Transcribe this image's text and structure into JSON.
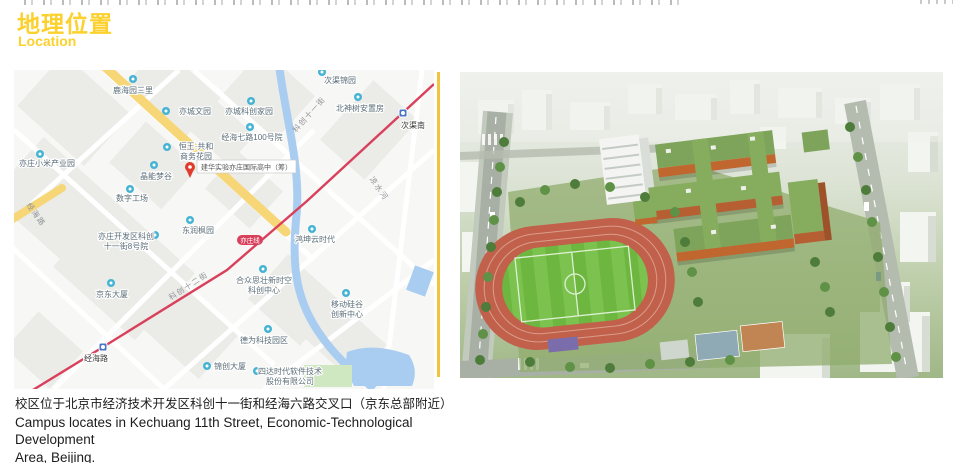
{
  "header": {
    "title_zh": "地理位置",
    "title_en": "Location",
    "accent_color": "#fcd12e"
  },
  "map": {
    "colors": {
      "poi": "#45b4d3",
      "metro_line": "#d8405b",
      "river": "#a9cdf1",
      "road_yellow": "#f6d677",
      "station": "#4a74c9",
      "pin": "#e03b2b"
    },
    "pin": {
      "x": 176,
      "y": 97,
      "label": "建华实验亦庄国际高中（筹）"
    },
    "line_badge": {
      "text": "亦庄线",
      "x": 236,
      "y": 171
    },
    "stations": [
      {
        "name": "次渠南",
        "icon": [
          389,
          43
        ],
        "label": [
          399,
          58
        ]
      },
      {
        "name": "经海路",
        "icon": [
          89,
          277
        ],
        "label": [
          82,
          291
        ]
      }
    ],
    "pois": [
      {
        "lines": [
          "鹿海园三里"
        ],
        "icon": [
          119,
          9
        ],
        "label": [
          119,
          23
        ]
      },
      {
        "lines": [
          "亦城文园"
        ],
        "icon": [
          152,
          41
        ],
        "label": [
          181,
          44
        ]
      },
      {
        "lines": [
          "亦城科创家园"
        ],
        "icon": [
          237,
          31
        ],
        "label": [
          235,
          44
        ]
      },
      {
        "lines": [
          "经海七路100号院"
        ],
        "icon": [
          236,
          57
        ],
        "label": [
          238,
          70
        ]
      },
      {
        "lines": [
          "恒王·共和",
          "商务花园"
        ],
        "icon": [
          153,
          77
        ],
        "label": [
          182,
          79
        ]
      },
      {
        "lines": [
          "晶能梦谷"
        ],
        "icon": [
          140,
          95
        ],
        "label": [
          142,
          109
        ]
      },
      {
        "lines": [
          "亦庄小米产业园"
        ],
        "icon": [
          26,
          84
        ],
        "label": [
          33,
          96
        ]
      },
      {
        "lines": [
          "数字工场"
        ],
        "icon": [
          116,
          119
        ],
        "label": [
          118,
          131
        ]
      },
      {
        "lines": [
          "亦庄开发区科创",
          "十一街8号院"
        ],
        "icon": [
          141,
          165
        ],
        "label": [
          112,
          169
        ]
      },
      {
        "lines": [
          "东润枫园"
        ],
        "icon": [
          176,
          150
        ],
        "label": [
          184,
          163
        ]
      },
      {
        "lines": [
          "鸿坤云时代"
        ],
        "icon": [
          298,
          159
        ],
        "label": [
          301,
          172
        ]
      },
      {
        "lines": [
          "京东大厦"
        ],
        "icon": [
          97,
          213
        ],
        "label": [
          98,
          227
        ]
      },
      {
        "lines": [
          "合众思壮新时空",
          "科创中心"
        ],
        "icon": [
          249,
          199
        ],
        "label": [
          250,
          213
        ]
      },
      {
        "lines": [
          "移动硅谷",
          "创新中心"
        ],
        "icon": [
          332,
          223
        ],
        "label": [
          333,
          237
        ]
      },
      {
        "lines": [
          "德为科技园区"
        ],
        "icon": [
          254,
          259
        ],
        "label": [
          250,
          273
        ]
      },
      {
        "lines": [
          "锦创大厦"
        ],
        "icon": [
          193,
          296
        ],
        "label": [
          216,
          299
        ]
      },
      {
        "lines": [
          "四达时代软件技术",
          "股份有限公司"
        ],
        "icon": [
          243,
          301
        ],
        "label": [
          276,
          304
        ]
      },
      {
        "lines": [
          "次渠锦园"
        ],
        "icon": [
          308,
          2
        ],
        "label": [
          326,
          13
        ]
      },
      {
        "lines": [
          "北神树安置房"
        ],
        "icon": [
          344,
          27
        ],
        "label": [
          346,
          41
        ]
      }
    ],
    "road_labels": [
      {
        "text": "科创十一街",
        "x": 297,
        "y": 46,
        "rot": -48
      },
      {
        "text": "科创十二街",
        "x": 176,
        "y": 218,
        "rot": -33
      },
      {
        "text": "经海路",
        "x": 20,
        "y": 146,
        "rot": 55
      },
      {
        "text": "凉水河",
        "x": 363,
        "y": 120,
        "rot": 55
      }
    ]
  },
  "caption": {
    "line1_zh": "校区位于北京市经济技术开发区科创十一街和经海六路交叉口（京东总部附近）",
    "line2_en": "Campus locates in Kechuang 11th Street, Economic-Technological Development",
    "line3_en": "Area, Beijing.",
    "line4_en": "(near Jingdong's global headquarter)"
  }
}
